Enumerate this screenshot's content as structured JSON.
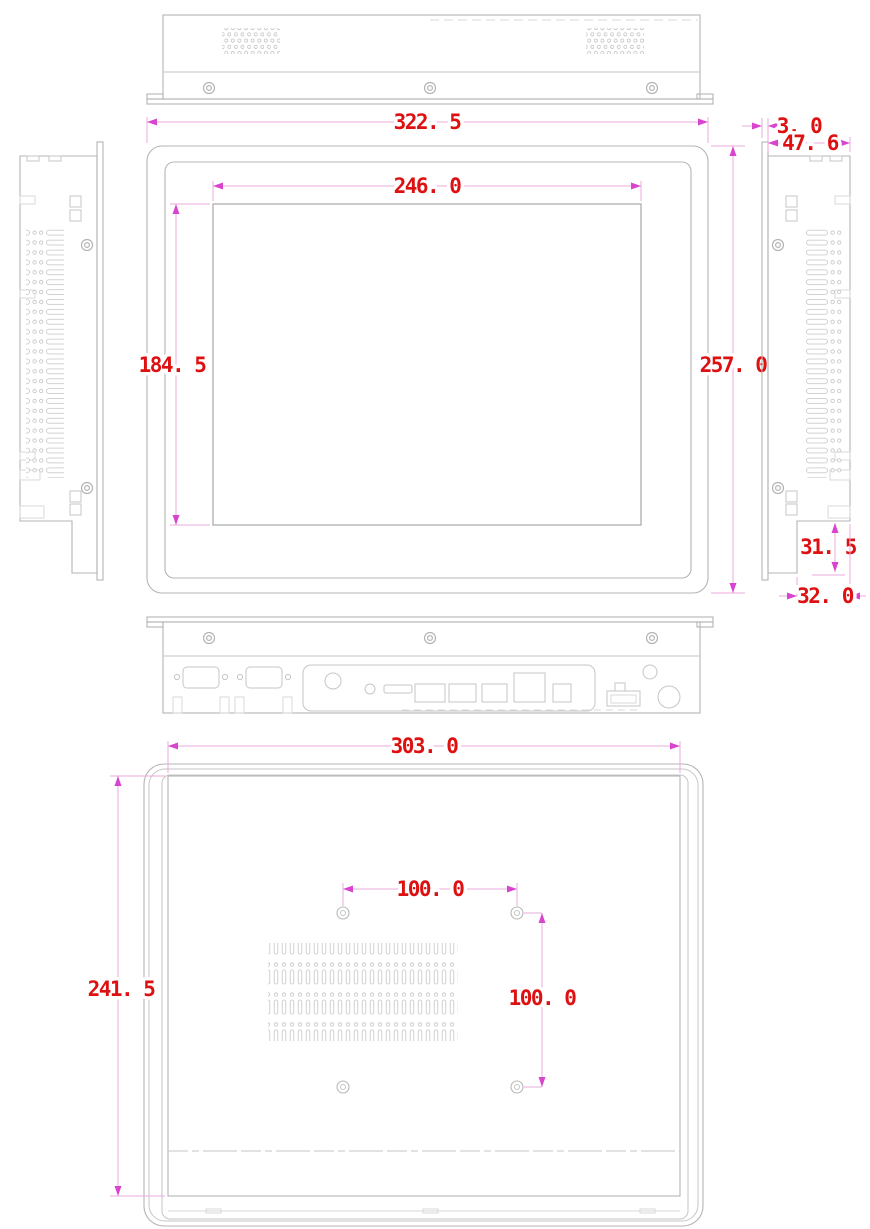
{
  "views": {
    "front": {
      "overall_width": "322. 5",
      "display_width": "246. 0",
      "display_height": "184. 5",
      "overall_height": "257. 0"
    },
    "side": {
      "front_bezel_depth": "3. 0",
      "overall_depth": "47. 6",
      "rear_step_height": "31. 5",
      "rear_step_depth": "32. 0"
    },
    "rear": {
      "body_width": "303. 0",
      "body_height": "241. 5",
      "vesa_spacing_horizontal": "100. 0",
      "vesa_spacing_vertical": "100. 0"
    }
  },
  "colors": {
    "dimension_text": "#dd1111",
    "dimension_line": "#eba8dd",
    "arrow": "#d944cf",
    "outline": "#b4b4b4"
  }
}
